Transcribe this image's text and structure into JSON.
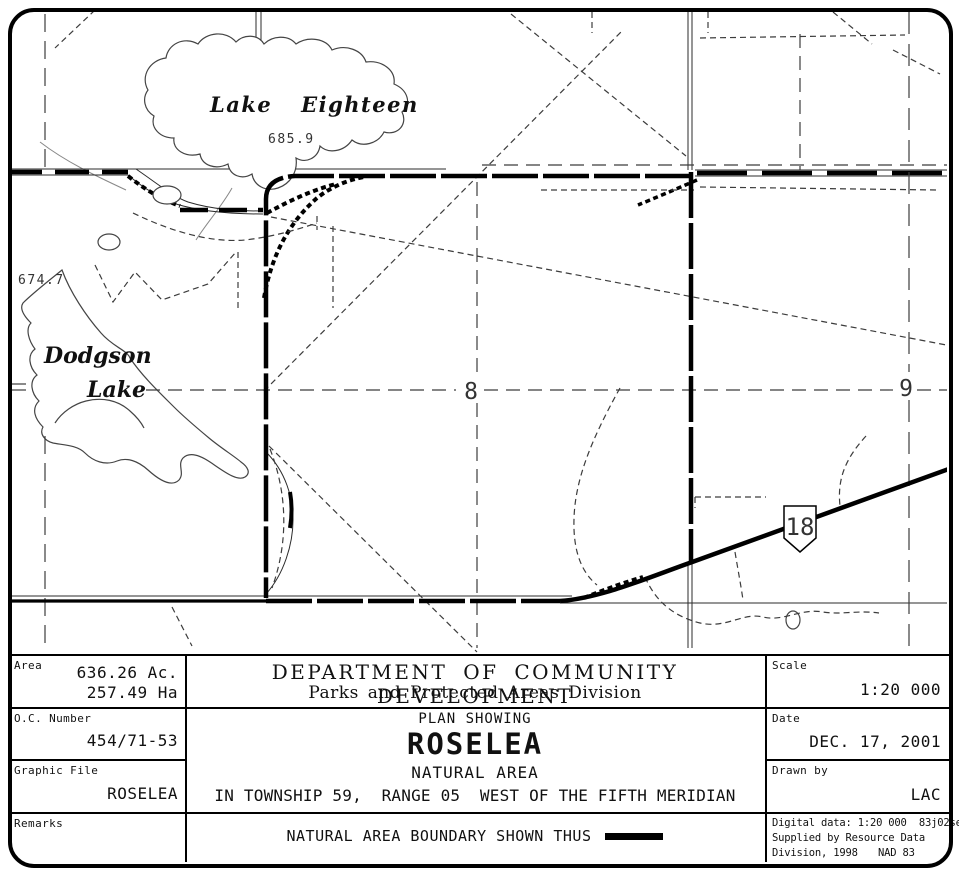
{
  "map": {
    "labels": {
      "lake_eighteen": "Lake Eighteen",
      "lake_eighteen_elevation": "685.9",
      "dodgson_word1": "Dodgson",
      "dodgson_word2": "Lake",
      "dodgson_elevation": "674.7",
      "section_8": "8",
      "section_9": "9",
      "highway_number": "18"
    }
  },
  "title_block": {
    "area": {
      "label": "Area",
      "acres": "636.26 Ac.",
      "hectares": "257.49 Ha"
    },
    "oc_number": {
      "label": "O.C. Number",
      "value": "454/71-53"
    },
    "graphic_file": {
      "label": "Graphic File",
      "value": "ROSELEA"
    },
    "remarks": {
      "label": "Remarks"
    },
    "department": {
      "line1": "DEPARTMENT OF COMMUNITY DEVELOPMENT",
      "line2": "Parks and Protected Areas Division"
    },
    "plan": {
      "kicker": "PLAN SHOWING",
      "title": "ROSELEA",
      "subtitle": "NATURAL AREA",
      "location": "IN TOWNSHIP 59,  RANGE 05  WEST OF THE FIFTH MERIDIAN"
    },
    "legend": {
      "text": "NATURAL AREA BOUNDARY SHOWN THUS"
    },
    "scale": {
      "label": "Scale",
      "value": "1:20 000"
    },
    "date": {
      "label": "Date",
      "value": "DEC. 17, 2001"
    },
    "drawn_by": {
      "label": "Drawn by",
      "value": "LAC"
    },
    "digital_data": {
      "line1": "Digital data: 1:20 000  83j02se",
      "line2": "Supplied by Resource Data",
      "line3": "Division, 1998",
      "datum": "NAD 83"
    }
  },
  "colors": {
    "ink": "#111111",
    "boundary": "#000000",
    "trail": "#3c3c3c",
    "shore": "#444444"
  }
}
